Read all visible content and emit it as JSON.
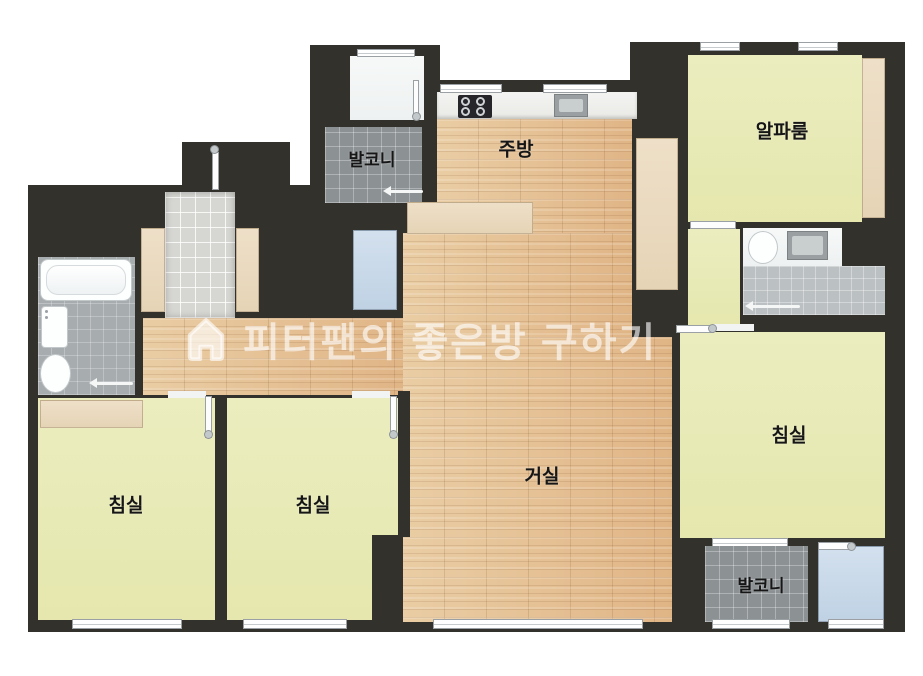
{
  "title": "apartment-floor-plan",
  "watermark": {
    "icon": "house-icon",
    "brand_text": "피터팬의 좋은방 구하기"
  },
  "rooms": {
    "balcony_top": "발코니",
    "kitchen": "주방",
    "alpha_room": "알파룸",
    "living_room": "거실",
    "bedroom_left": "침실",
    "bedroom_middle": "침실",
    "bedroom_right": "침실",
    "balcony_bottom": "발코니"
  },
  "colors": {
    "wall": "#33312b",
    "wood_floor": "#e5c094",
    "room_yellow": "#e9eab7",
    "balcony_tile": "#8c9194",
    "entry_tile": "#d6d6d3",
    "bath_tile_left": "#a7acaf",
    "bath_tile_right": "#bbc0c2",
    "closet_beige": "#ead9bf",
    "utility_blue": "#c5d7e8",
    "fixture_white": "#f5f6f6",
    "watermark_white": "rgba(255,255,255,0.6)"
  }
}
